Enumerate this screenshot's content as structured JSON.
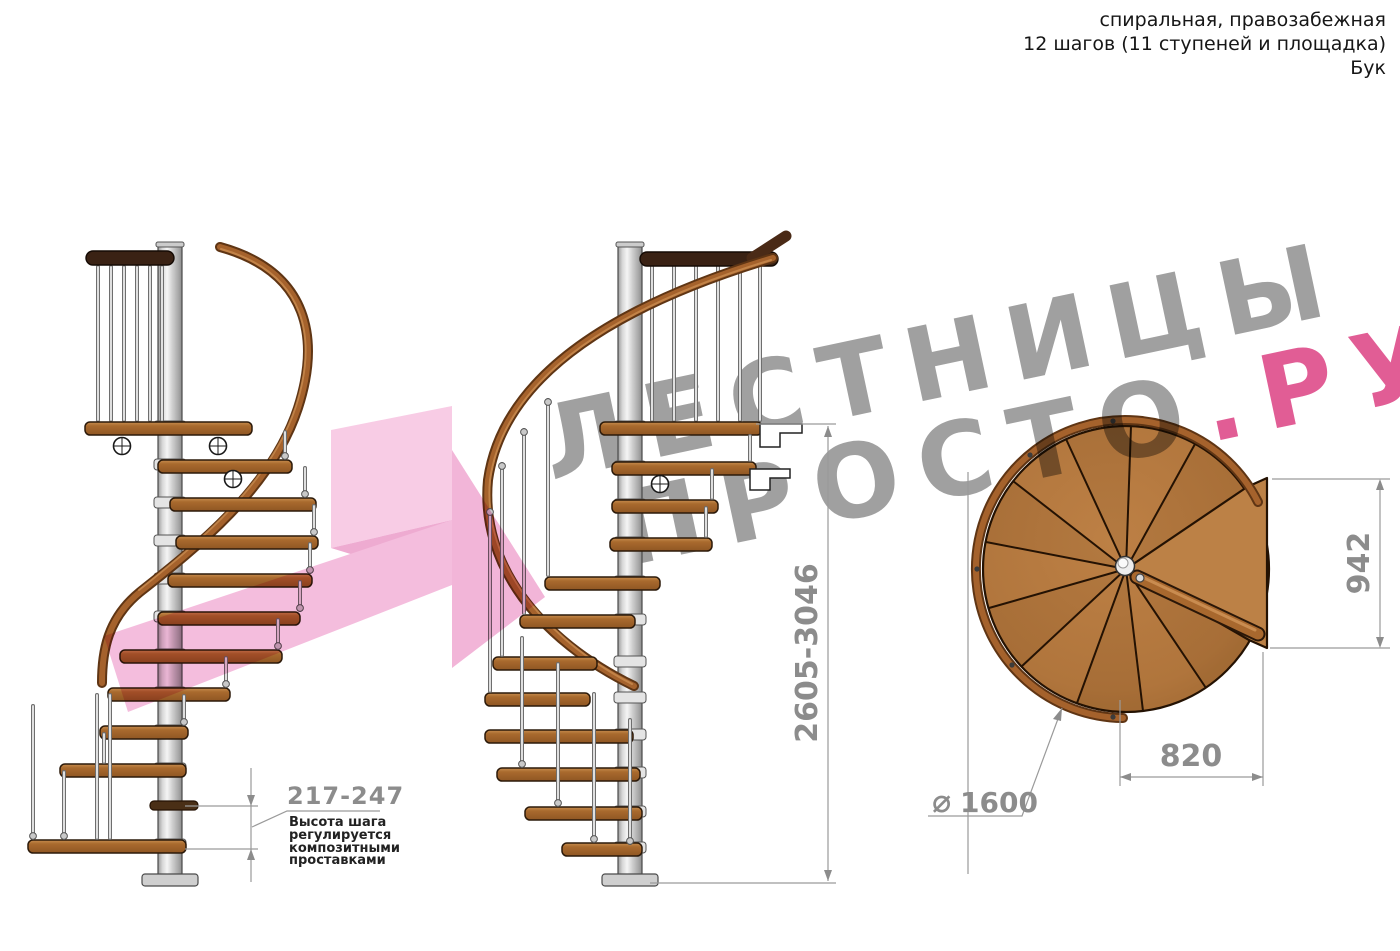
{
  "header": {
    "line1": "спиральная, правозабежная",
    "line2": "12 шагов (11 ступеней и площадка)",
    "line3": "Бук"
  },
  "watermark": {
    "word1": "ЛЕСТНИЦЫ",
    "word2": "ПРОСТО",
    "suffix": ".РУ",
    "gray": "#9b9b9b",
    "pink": "#e0548f",
    "arrow_pink": "#f3b1d7"
  },
  "dimensions": {
    "step_height": "217-247",
    "note_lines": [
      "Высота шага",
      "регулируется",
      "композитными",
      "проставками"
    ],
    "total_height": "2605-3046",
    "platform_depth": "942",
    "platform_width": "820",
    "diameter_symbol": "⌀",
    "diameter_value": "1600"
  },
  "colors": {
    "wood": "#a96a2e",
    "wood_dark": "#3a2214",
    "metal_pole": "#d6d6d6",
    "dimension_gray": "#8c8c8c",
    "text_dark": "#161616"
  }
}
